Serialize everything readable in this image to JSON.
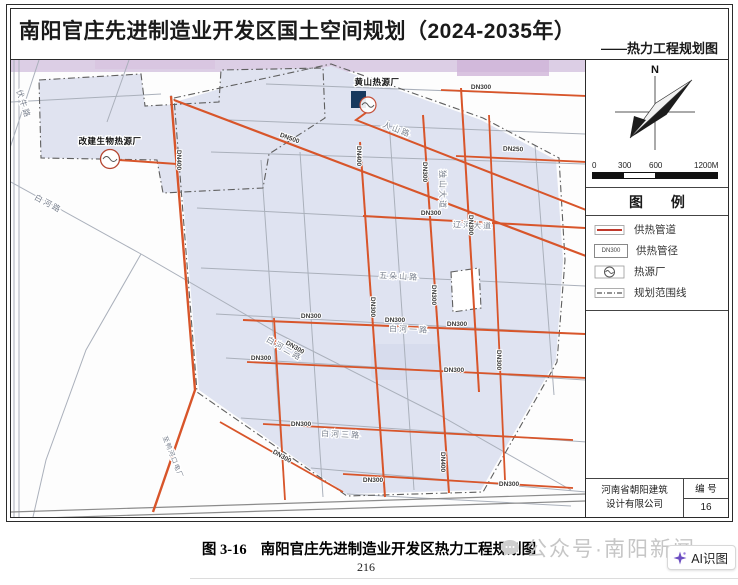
{
  "frame": {
    "title": "南阳官庄先进制造业开发区国土空间规划（2024-2035年）",
    "subtitle": "——热力工程规划图"
  },
  "sidebar": {
    "compass_label": "N",
    "scale": {
      "ticks": [
        "0",
        "300",
        "600",
        "1200M"
      ]
    },
    "legend": {
      "header": "图 例",
      "items": [
        {
          "label": "供热管道"
        },
        {
          "symbol_text": "DN300",
          "label": "供热管径"
        },
        {
          "label": "热源厂"
        },
        {
          "label": "规划范围线"
        }
      ]
    },
    "title_block": {
      "company_line1": "河南省朝阳建筑",
      "company_line2": "设计有限公司",
      "no_label": "编 号",
      "no_value": "16"
    }
  },
  "map": {
    "plants": [
      {
        "label": "改建生物热源厂"
      },
      {
        "label": "黄山热源厂"
      }
    ],
    "roads": [
      "白河路",
      "伏牛路",
      "人山路",
      "五朵山路",
      "辽河大道",
      "独山大道",
      "白河一路",
      "白河二路",
      "白河三路",
      "至鸭河口电厂"
    ],
    "dn_labels": [
      "DN400",
      "DN500",
      "DN250",
      "DN300",
      "DN300",
      "DN300",
      "DN300",
      "DN300",
      "DN300",
      "DN300",
      "DN300",
      "DN300",
      "DN300",
      "DN400",
      "DN300",
      "DN300",
      "DN300",
      "DN300",
      "DN300",
      "DN300",
      "DN400",
      "DN300"
    ]
  },
  "footer": {
    "caption_fig": "图 3-16",
    "caption_text": "南阳官庄先进制造业开发区热力工程规划图",
    "page_number": "216",
    "watermark": "公众号·南阳新闻",
    "ai_badge": "AI识图"
  },
  "colors": {
    "pipe": "#d8552a",
    "parcel": "#dfe3f1",
    "purple": "#cdb9da",
    "road": "#aab0bb",
    "boundary": "#5f5f5f",
    "legend_line": "#c0392b"
  }
}
